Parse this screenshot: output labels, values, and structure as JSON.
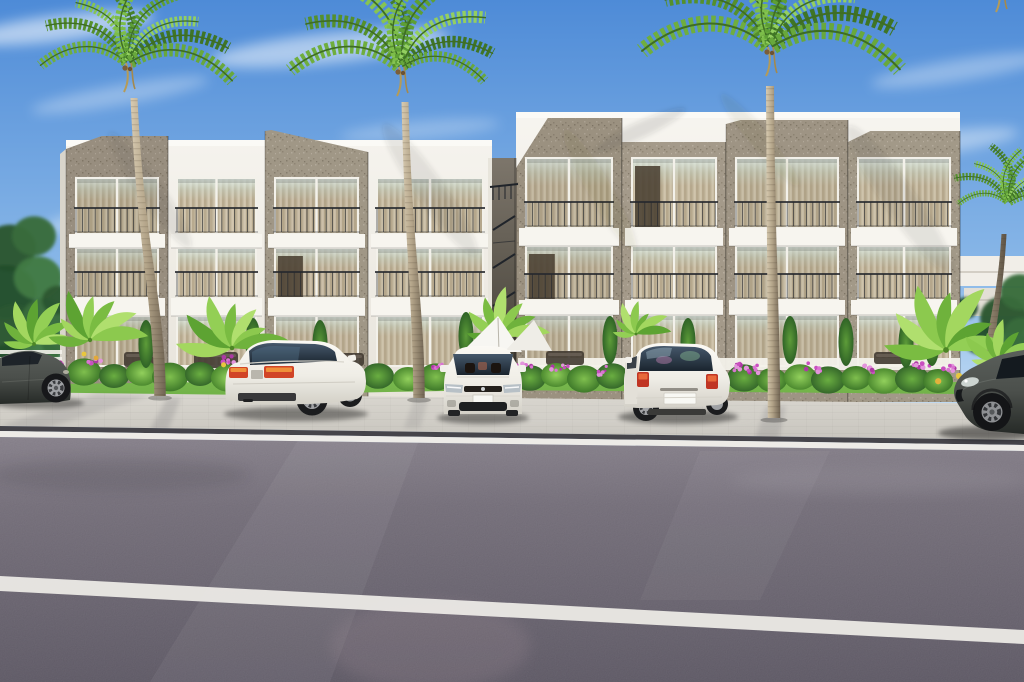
{
  "meta": {
    "title": "Tropical modern apartment complex — exterior 3D architectural rendering",
    "image_type": "photorealistic render, no text or UI elements",
    "width": 1024,
    "height": 682
  },
  "palette": {
    "sky_top": "#4e8bd7",
    "sky_mid": "#8ab8e8",
    "sky_low": "#c6def4",
    "horizon": "#e6f1fa",
    "wall_white": "#f7f5f0",
    "wall_shadow": "#e7e3da",
    "stone_base": "#a79d8c",
    "curtain_base": "#c9bda5",
    "curtain_stripe": "#b8aa8f",
    "railing_dark": "#26292e",
    "grass": "#6cae44",
    "sidewalk_light": "#dad7d0",
    "sidewalk_dark": "#c7c4bd",
    "curb_dark": "#45444a",
    "curb_white": "#edebe7",
    "road_light": "#837d87",
    "road_mid": "#6f6974",
    "road_dark": "#595460",
    "lane_white": "#eae8e4",
    "car_white": "#fbf9f4",
    "car_dark": "#4b4f4b",
    "tree_greens": [
      "#2c5731",
      "#386b3c",
      "#244d29",
      "#417a44"
    ],
    "palm_greens": [
      "#6fae3e",
      "#55902c",
      "#86c452",
      "#47812a",
      "#7cbd49",
      "#5d9f35",
      "#93cf60",
      "#3f7526",
      "#68a83c"
    ],
    "banana_greens": [
      "#8cc94e",
      "#6fb23c",
      "#a3d75f",
      "#5da332",
      "#93cf55",
      "#7abc42",
      "#b0df6e"
    ],
    "flower_pinks": [
      "#c94fc0",
      "#da74d2",
      "#ad39a4",
      "#e394dc"
    ]
  },
  "scene": {
    "sky": {
      "clouds": [
        {
          "x": 60,
          "y": 28,
          "rx": 95,
          "ry": 13,
          "rot": -7,
          "o": 0.55
        },
        {
          "x": 330,
          "y": 48,
          "rx": 120,
          "ry": 15,
          "rot": -6,
          "o": 0.5
        },
        {
          "x": 120,
          "y": 95,
          "rx": 90,
          "ry": 10,
          "rot": -10,
          "o": 0.3
        },
        {
          "x": 150,
          "y": 205,
          "rx": 110,
          "ry": 12,
          "rot": -13,
          "o": 0.38
        },
        {
          "x": 420,
          "y": 130,
          "rx": 80,
          "ry": 9,
          "rot": -5,
          "o": 0.25
        },
        {
          "x": 660,
          "y": 180,
          "rx": 170,
          "ry": 16,
          "rot": -5,
          "o": 0.45
        },
        {
          "x": 890,
          "y": 150,
          "rx": 130,
          "ry": 13,
          "rot": -8,
          "o": 0.4
        },
        {
          "x": 960,
          "y": 70,
          "rx": 90,
          "ry": 11,
          "rot": -9,
          "o": 0.32
        },
        {
          "x": 530,
          "y": 235,
          "rx": 120,
          "ry": 10,
          "rot": -4,
          "o": 0.3
        }
      ]
    },
    "background": {
      "trees_left": [
        [
          10,
          248,
          26
        ],
        [
          34,
          236,
          22
        ],
        [
          6,
          292,
          30
        ],
        [
          38,
          278,
          24
        ],
        [
          14,
          330,
          28
        ],
        [
          44,
          318,
          22
        ],
        [
          8,
          366,
          24
        ],
        [
          40,
          358,
          20
        ],
        [
          58,
          300,
          16
        ],
        [
          56,
          344,
          14
        ],
        [
          24,
          388,
          18
        ],
        [
          52,
          382,
          14
        ]
      ],
      "trees_right": [
        [
          1004,
          318,
          24
        ],
        [
          1020,
          292,
          20
        ],
        [
          980,
          340,
          16
        ],
        [
          1012,
          352,
          22
        ],
        [
          996,
          372,
          18
        ],
        [
          1022,
          334,
          18
        ],
        [
          966,
          308,
          12
        ],
        [
          988,
          386,
          14
        ]
      ],
      "distant_buildings": "low white flat-roof volumes behind right palms"
    },
    "buildings": {
      "description": "Two modern three-story apartment blocks; white stucco with protruding speckled stone volumes, full-height curtained glazing, white balcony slabs, dark Juliet railings",
      "left": {
        "x": 66,
        "w": 426,
        "parapet": 140,
        "base": 402,
        "floors": [
          [
            178,
            234
          ],
          [
            248,
            298
          ],
          [
            316,
            366
          ]
        ],
        "slabs": [
          [
            234,
            248
          ],
          [
            298,
            316
          ]
        ],
        "bays": [
          {
            "kind": "stone",
            "x": 66,
            "w": 102,
            "top": [
              149,
              136,
              136
            ],
            "bev": 0.35,
            "shade": 0.12
          },
          {
            "kind": "white",
            "x": 168,
            "w": 97,
            "top": [
              140,
              140,
              140
            ],
            "bev": 0.5,
            "shade": 0
          },
          {
            "kind": "stone",
            "x": 265,
            "w": 103,
            "top": [
              131,
              130,
              152
            ],
            "bev": 0.06,
            "shade": 0.05
          },
          {
            "kind": "white",
            "x": 368,
            "w": 124,
            "top": [
              150,
              150,
              150
            ],
            "bev": 0.5,
            "shade": 0.03
          }
        ],
        "doors": [
          {
            "bay": 2,
            "floor": 1,
            "side": "L"
          }
        ]
      },
      "right": {
        "x": 516,
        "w": 444,
        "parapet": 112,
        "base": 402,
        "floors": [
          [
            158,
            228
          ],
          [
            246,
            300
          ],
          [
            315,
            366
          ]
        ],
        "slabs": [
          [
            228,
            246
          ],
          [
            300,
            315
          ]
        ],
        "bays": [
          {
            "kind": "stone",
            "x": 516,
            "w": 106,
            "top": [
              168,
              118,
              118
            ],
            "bev": 0.3,
            "shade": 0.1
          },
          {
            "kind": "stone",
            "x": 622,
            "w": 104,
            "top": [
              142,
              142,
              142
            ],
            "bev": 0.5,
            "shade": 0.02
          },
          {
            "kind": "stone",
            "x": 726,
            "w": 122,
            "top": [
              124,
              120,
              120
            ],
            "bev": 0.12,
            "shade": 0.07
          },
          {
            "kind": "stone",
            "x": 848,
            "w": 112,
            "top": [
              142,
              131,
              131
            ],
            "bev": 0.2,
            "shade": 0.03
          }
        ],
        "doors": [
          {
            "bay": 0,
            "floor": 1,
            "side": "L"
          },
          {
            "bay": 1,
            "floor": 0,
            "side": "L"
          }
        ]
      },
      "stair_gap": {
        "x": 492,
        "w": 24,
        "feature": "recessed breezeway with dark metal stair railings and roof-access rail"
      }
    },
    "palms": [
      {
        "name": "palm-tree-1",
        "crown": [
          128,
          62
        ],
        "trunkTop": [
          134,
          98
        ],
        "base": [
          160,
          396
        ],
        "scale": 1.0,
        "tw": 7,
        "layer": "front"
      },
      {
        "name": "palm-tree-2",
        "crown": [
          401,
          66
        ],
        "trunkTop": [
          405,
          102
        ],
        "base": [
          419,
          398
        ],
        "scale": 1.04,
        "tw": 7,
        "layer": "front"
      },
      {
        "name": "palm-tree-3",
        "crown": [
          770,
          46
        ],
        "trunkTop": [
          770,
          86
        ],
        "base": [
          774,
          418
        ],
        "scale": 1.24,
        "tw": 8,
        "layer": "front"
      },
      {
        "name": "palm-tree-4",
        "crown": [
          1008,
          202
        ],
        "trunkTop": [
          1004,
          234
        ],
        "base": [
          986,
          390
        ],
        "scale": 0.6,
        "tw": 5,
        "dark": true,
        "layer": "back"
      },
      {
        "name": "palm-tree-5",
        "crown": [
          1000,
          -18
        ],
        "scale": 1.25,
        "layer": "back"
      }
    ],
    "hedges": {
      "bushes": [
        [
          84,
          372,
          17,
          0
        ],
        [
          114,
          376,
          15,
          1
        ],
        [
          142,
          373,
          16,
          2
        ],
        [
          170,
          377,
          18,
          0
        ],
        [
          200,
          374,
          15,
          1
        ],
        [
          228,
          378,
          17,
          2
        ],
        [
          258,
          375,
          16,
          0
        ],
        [
          288,
          378,
          18,
          1
        ],
        [
          318,
          375,
          15,
          2
        ],
        [
          348,
          379,
          17,
          0
        ],
        [
          378,
          376,
          16,
          1
        ],
        [
          408,
          379,
          15,
          2
        ],
        [
          436,
          377,
          17,
          0
        ],
        [
          530,
          378,
          16,
          1
        ],
        [
          556,
          375,
          15,
          2
        ],
        [
          584,
          379,
          17,
          0
        ],
        [
          612,
          376,
          16,
          1
        ],
        [
          640,
          379,
          15,
          0
        ],
        [
          668,
          377,
          16,
          2
        ],
        [
          744,
          378,
          17,
          1
        ],
        [
          772,
          380,
          15,
          0
        ],
        [
          800,
          377,
          16,
          2
        ],
        [
          828,
          380,
          17,
          1
        ],
        [
          856,
          378,
          15,
          0
        ],
        [
          884,
          381,
          16,
          2
        ],
        [
          912,
          379,
          17,
          1
        ],
        [
          938,
          381,
          15,
          0
        ]
      ]
    },
    "flowers": [
      [
        58,
        366
      ],
      [
        96,
        362
      ],
      [
        230,
        360
      ],
      [
        250,
        366
      ],
      [
        438,
        366
      ],
      [
        524,
        366
      ],
      [
        560,
        368
      ],
      [
        600,
        370
      ],
      [
        640,
        368
      ],
      [
        700,
        369
      ],
      [
        738,
        366
      ],
      [
        752,
        370
      ],
      [
        812,
        368
      ],
      [
        868,
        369
      ],
      [
        922,
        366
      ],
      [
        948,
        368
      ]
    ],
    "cypresses": [
      [
        146,
        344
      ],
      [
        253,
        342
      ],
      [
        320,
        344
      ],
      [
        466,
        336
      ],
      [
        610,
        340
      ],
      [
        688,
        342
      ],
      [
        790,
        340
      ],
      [
        846,
        342
      ],
      [
        906,
        344
      ],
      [
        932,
        342
      ]
    ],
    "bananas": [
      {
        "x": 34,
        "y": 344,
        "s": 0.85
      },
      {
        "x": 90,
        "y": 340,
        "s": 1.0,
        "accents": [
          [
            -6,
            14,
            "#e8c73e"
          ],
          [
            6,
            18,
            "#e2a93a"
          ]
        ]
      },
      {
        "x": 232,
        "y": 348,
        "s": 1.05,
        "accents": [
          [
            -8,
            16,
            "#e8c73e"
          ]
        ]
      },
      {
        "x": 502,
        "y": 336,
        "s": 0.9
      },
      {
        "x": 636,
        "y": 334,
        "s": 0.65
      },
      {
        "x": 946,
        "y": 350,
        "s": 1.3,
        "accents": [
          [
            10,
            20,
            "#e8c73e"
          ],
          [
            22,
            26,
            "#dd8f35"
          ],
          [
            -6,
            24,
            "#e3b23c"
          ]
        ]
      },
      {
        "x": 1000,
        "y": 362,
        "s": 0.75
      }
    ],
    "furniture": [
      [
        124,
        352,
        40,
        15
      ],
      [
        194,
        352,
        44,
        16
      ],
      [
        330,
        353,
        34,
        13
      ],
      [
        546,
        351,
        38,
        14
      ],
      [
        874,
        352,
        30,
        12
      ]
    ],
    "cars": [
      {
        "name": "car-dark-hatchback-left",
        "body_color": "#4b4f4b",
        "position": "far left, cropped by frame edge",
        "facing": "right"
      },
      {
        "name": "car-white-sedan",
        "body_color": "#fbf9f4",
        "position": "left-center parking bay",
        "view": "rear three-quarter",
        "details": "red-amber taillights, dark rear diffuser, alloy wheels"
      },
      {
        "name": "car-white-compact",
        "body_color": "#fbf9f4",
        "position": "center parking bay",
        "view": "front",
        "details": "dark windshield, twin headlights, dark lower intake"
      },
      {
        "name": "car-white-hatchback",
        "body_color": "#fbf9f4",
        "position": "right-center parking bay",
        "view": "rear",
        "details": "tinted hatch glass with colorful reflections, white license plate"
      },
      {
        "name": "car-dark-suv-right",
        "body_color": "#3a403d",
        "position": "far right, cropped by frame edge",
        "view": "front three-quarter",
        "details": "large alloy wheel, bright headlight"
      }
    ],
    "road": {
      "curb_edge": "runs from y≈426 at left to y≈440 at right, dark curb strip with white edge line",
      "lane_marking": {
        "from": [
          0,
          576
        ],
        "to": [
          1024,
          630
        ],
        "thickness": 15,
        "color": "#eae8e4"
      },
      "surface": "purple-grey asphalt with fine grain, sunlit diagonal streaks"
    }
  }
}
